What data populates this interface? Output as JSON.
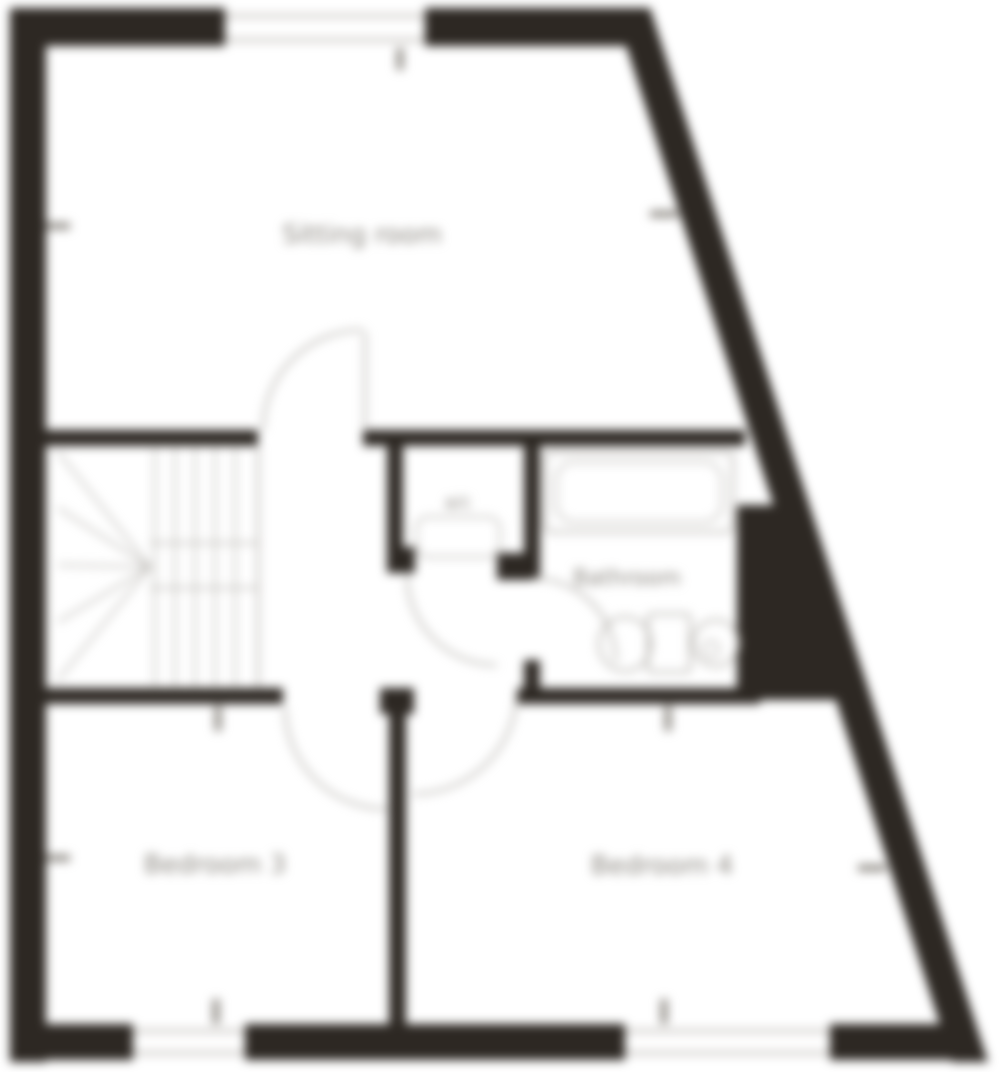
{
  "floorplan": {
    "rooms": {
      "sitting_room": {
        "label": "Sitting room"
      },
      "bedroom3": {
        "label": "Bedroom 3"
      },
      "bedroom4": {
        "label": "Bedroom 4"
      },
      "bathroom": {
        "label": "Bathroom"
      },
      "cupboard": {
        "label": "a/c"
      }
    },
    "colors": {
      "wall": "#2d2823",
      "line": "#b4b1ac",
      "window": "#c9c6c2",
      "tick": "#8f8b85",
      "text": "#8a867f",
      "background": "#ffffff"
    }
  }
}
